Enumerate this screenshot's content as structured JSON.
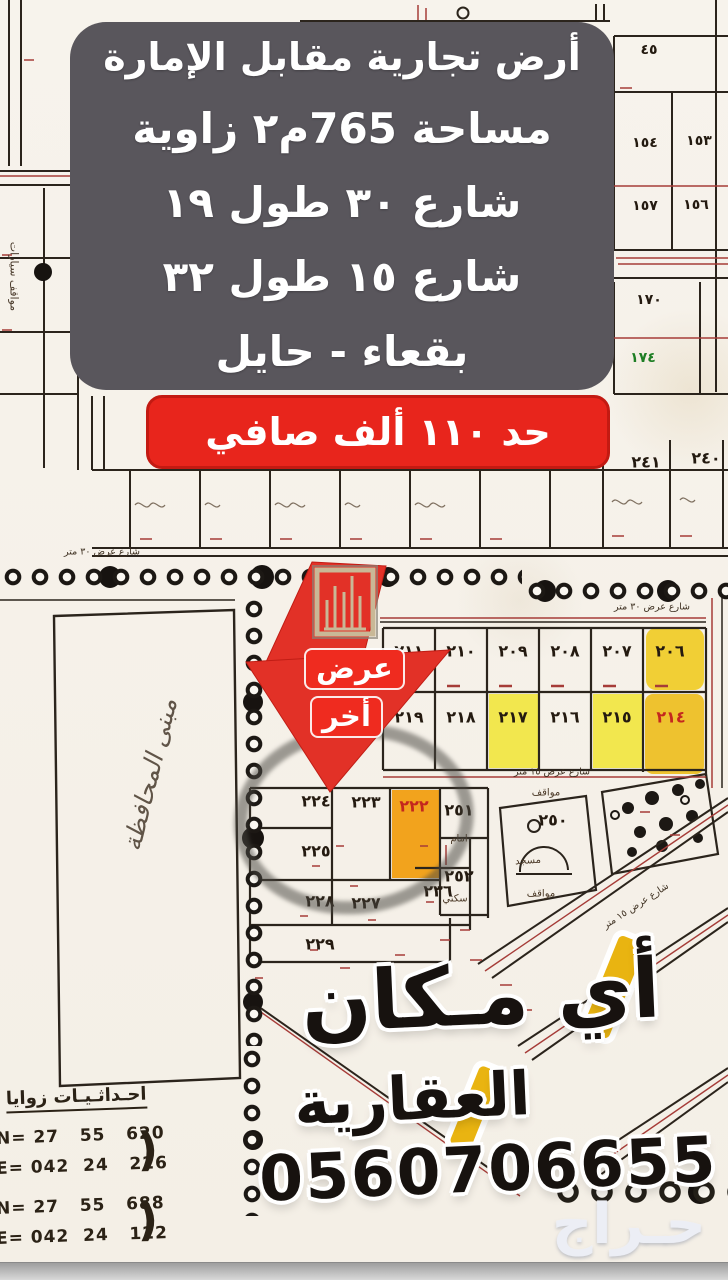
{
  "overlay": {
    "lines": [
      "أرض تجارية مقابل الإمارة",
      "مساحة 765م٢ زاوية",
      "شارع ٣٠ طول ١٩",
      "شارع ١٥ طول ٣٢",
      "بقعاء - حايل"
    ],
    "price": "حد ١١٠ ألف صافي",
    "offer_word1": "عرض",
    "offer_word2": "أخر"
  },
  "map": {
    "streets": {
      "top": "شارع عرض ٣٠ متر",
      "mid": "شارع عرض ١٥ متر",
      "diag": "شارع عرض ١٥ متر"
    },
    "labels": {
      "parking": "مواقف",
      "parking2": "مواقف",
      "parking_cars": "مواقف سيارات",
      "mosque": "مسجد",
      "front": "امام",
      "housing": "سكني",
      "left_block": "مبنى المحافظة"
    },
    "plots": {
      "top_right": [
        "٤٥",
        "١٥٤",
        "١٥٣",
        "١٥٧",
        "١٥٦",
        "١٧٠",
        "١٧٤"
      ],
      "mid_row": [
        "٢٤١",
        "٢٤٠"
      ],
      "upper_row": [
        "٢١١",
        "٢١٠",
        "٢٠٩",
        "٢٠٨",
        "٢٠٧",
        "٢٠٦"
      ],
      "lower_row": [
        "٢١٩",
        "٢١٨",
        "٢١٧",
        "٢١٦",
        "٢١٥",
        "٢١٤"
      ],
      "block": [
        "٢٢٤",
        "٢٢٣",
        "٢٢٢",
        "٢٥١",
        "٢٢٥",
        "٢٥٢",
        "٢٢٨",
        "٢٢٧",
        "٢٣٦",
        "٢٢٩"
      ],
      "mosque_plot": "٢٥٠"
    },
    "coordinates": {
      "heading": "احـداثـيـات زوايا",
      "n1": "N= 27   55   620",
      "e1": "E= 042  24   226",
      "n2": "N= 27   55   688",
      "e2": "E= 042  24   122",
      "bracket": ")"
    }
  },
  "branding": {
    "agency_line1": "أي مـكان",
    "agency_line2": "العقارية",
    "phone": "0560706655",
    "site_watermark": "حـراج"
  },
  "colors": {
    "overlay_bg": "#59565C",
    "banner_red": "#E8251C",
    "arrow_red": "#E23127",
    "highlight_yellow": "#F2E74E",
    "highlight_gold": "#EEC22F",
    "highlight_orange": "#F2A31D",
    "map_red": "#A63C38",
    "green_number": "#1E7E24",
    "slash_yellow": "#E9B411"
  }
}
